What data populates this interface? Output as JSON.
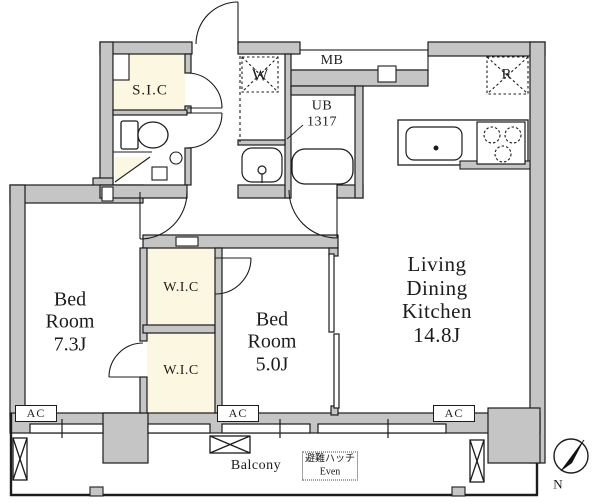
{
  "rooms": {
    "bedroom_1": "Bed\nRoom\n7.3J",
    "bedroom_2": "Bed\nRoom\n5.0J",
    "ldk": "Living\nDining\nKitchen\n14.8J",
    "shoe_closet": "S.I.C",
    "walk_in_closet_upper": "W.I.C",
    "walk_in_closet_lower": "W.I.C",
    "unit_bath": "UB\n1317",
    "balcony": "Balcony"
  },
  "markers": {
    "washer": "W",
    "meter_box": "MB",
    "refrigerator": "R",
    "ac_1": "AC",
    "ac_2": "AC",
    "ac_3": "AC",
    "evacuation_hatch": "避難ハッチ\nEven",
    "north": "N"
  },
  "colors": {
    "wall": "#c5c5c5",
    "closet_fill": "#fbf7e0",
    "line": "#1c1c1c",
    "background": "#ffffff"
  }
}
